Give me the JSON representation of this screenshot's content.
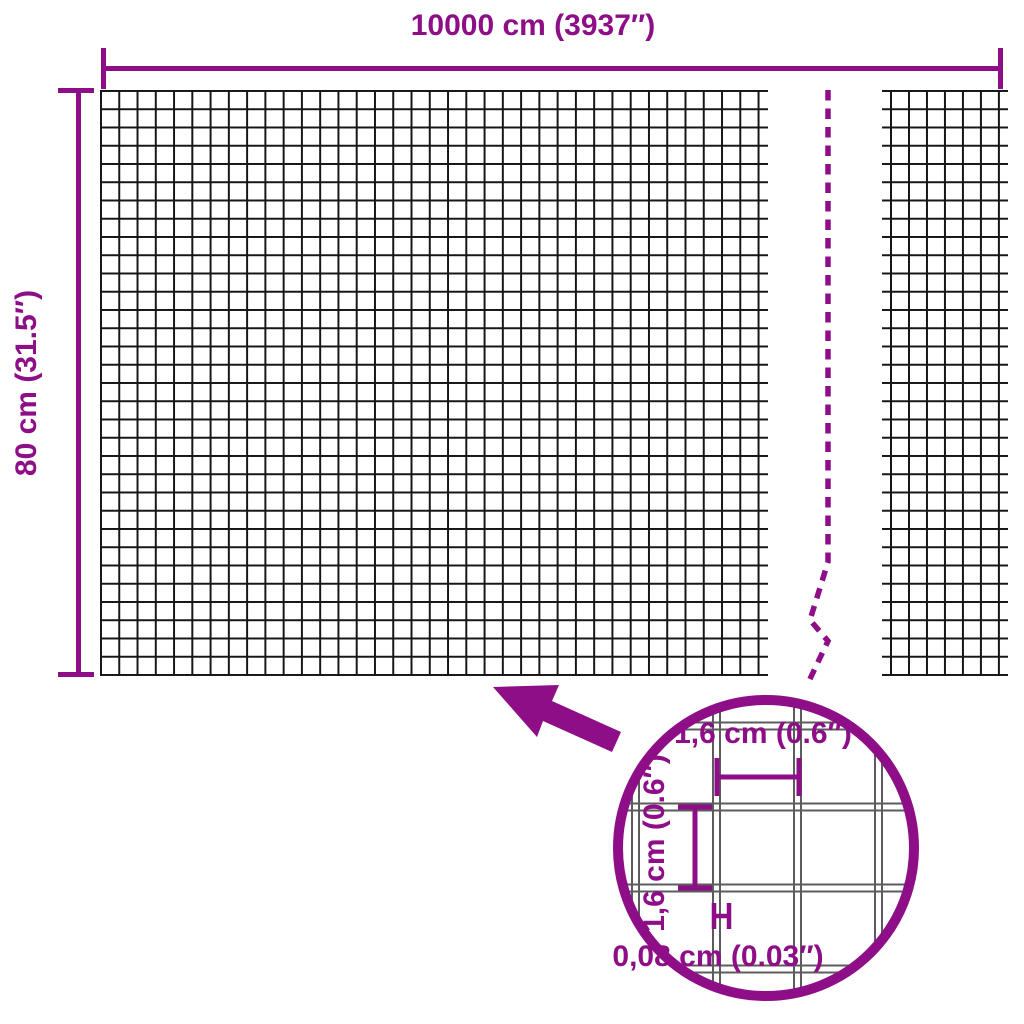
{
  "product_diagram": {
    "type": "wire-mesh-fence-dimension-diagram",
    "overall": {
      "width_label": "10000 cm (3937″)",
      "height_label": "80 cm (31.5″)"
    },
    "detail_view": {
      "cell_width_label": "1,6 cm (0.6″)",
      "cell_height_label": "1,6 cm (0.6″)",
      "wire_thickness_label": "0,08 cm (0.03″)"
    },
    "colors": {
      "accent": "#8E0E88",
      "mesh_line": "#161616",
      "detail_grid_line": "#5C5C5C",
      "background": "#FFFFFF"
    }
  }
}
